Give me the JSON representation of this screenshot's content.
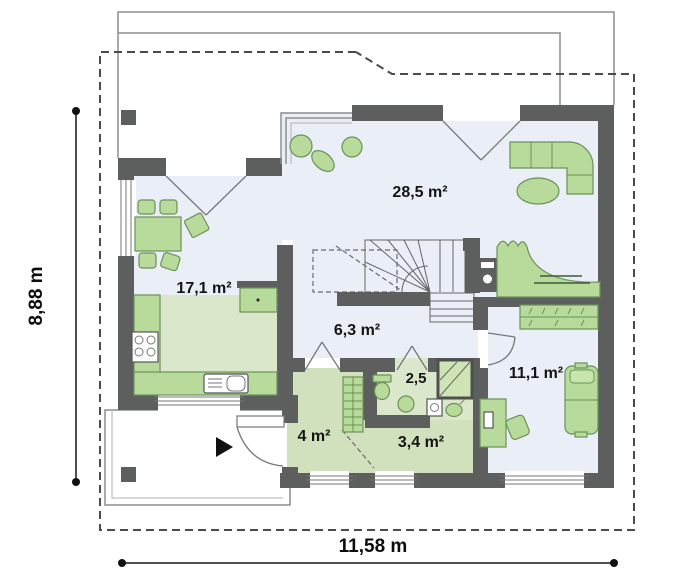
{
  "dimensions": {
    "width_label": "11,58 m",
    "height_label": "8,88 m"
  },
  "rooms": {
    "living_area": "28,5 m²",
    "kitchen_dining_area": "17,1 m²",
    "hall_area": "6,3 m²",
    "bathroom_area": "2,5",
    "bedroom_area": "11,1 m²",
    "entry_area": "4 m²",
    "utility_area": "3,4 m²"
  },
  "colors": {
    "wall": "#5d5e5e",
    "floor_living": "#e9eef7",
    "floor_service": "#dbe7ca",
    "furniture_fill": "#b8db9c",
    "furniture_stroke": "#6a9257",
    "dimension_text": "#0d0d0d"
  }
}
